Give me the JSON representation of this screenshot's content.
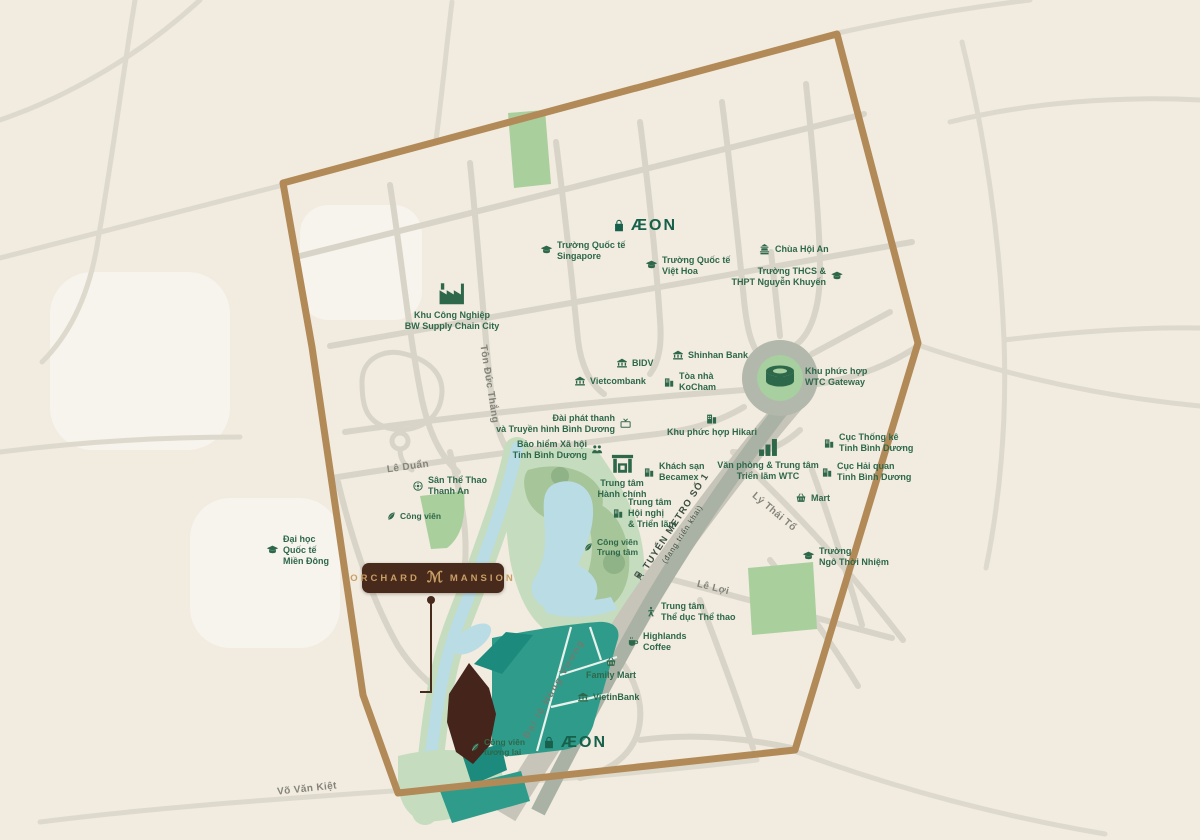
{
  "map": {
    "colors": {
      "bg": "#f1ebe0",
      "road": "#d8d4c8",
      "road_outer": "#ded9cd",
      "boundary": "#b28a58",
      "metro_band": "#a9b2a5",
      "boulevard_band": "#c7c4b9",
      "water": "#b9dce5",
      "park_light": "#c6dcbe",
      "park_mid": "#a6c598",
      "park_dark": "#8fb286",
      "green_patch": "#a9cf9d",
      "teal": "#2f9c8b",
      "teal_dark": "#1c8a7c",
      "site_brown": "#45241b",
      "poi_green": "#2e684a",
      "road_label": "#84847a",
      "metro_text": "#3a4f42",
      "aeon_green": "#17604b",
      "badge_bg": "#482a1d",
      "badge_gold": "#c89e63"
    },
    "project_badge": {
      "left": "ORCHARD",
      "monogram": "ℳ",
      "right": "MANSION"
    },
    "metro": {
      "label": "TUYẾN METRO SỐ 1",
      "sublabel": "(đang triển khai)"
    },
    "road_labels": [
      {
        "id": "le-duan",
        "text": "Lê Duẩn",
        "x": 408,
        "y": 467,
        "rot": -8,
        "variant": "plain"
      },
      {
        "id": "ton-duc-thang",
        "text": "Tôn Đức Thắng",
        "x": 489,
        "y": 384,
        "rot": 81,
        "variant": "plain"
      },
      {
        "id": "ly-thai-to",
        "text": "Lý Thái Tổ",
        "x": 774,
        "y": 512,
        "rot": 40,
        "variant": "plain"
      },
      {
        "id": "le-loi",
        "text": "Lê Lợi",
        "x": 713,
        "y": 588,
        "rot": 14,
        "variant": "plain"
      },
      {
        "id": "vo-van-kiet",
        "text": "Võ Văn Kiệt",
        "x": 307,
        "y": 789,
        "rot": -6,
        "variant": "plain"
      },
      {
        "id": "dai-lo-hung-vuong",
        "text": "Đại lộ Hùng Vương",
        "x": 554,
        "y": 689,
        "rot": -60,
        "variant": "band"
      }
    ],
    "pois": [
      {
        "id": "aeon-top",
        "icon": "bag-icon",
        "lines": [
          "ÆON"
        ],
        "x": 612,
        "y": 216,
        "layout": "row",
        "cls": "aeon",
        "icon_size": 14
      },
      {
        "id": "school-singapore",
        "icon": "school-icon",
        "lines": [
          "Trường Quốc tế",
          "Singapore"
        ],
        "x": 540,
        "y": 240,
        "layout": "row",
        "icon_size": 13
      },
      {
        "id": "school-viet-hoa",
        "icon": "school-icon",
        "lines": [
          "Trường Quốc tế",
          "Việt Hoa"
        ],
        "x": 645,
        "y": 255,
        "layout": "row",
        "icon_size": 13
      },
      {
        "id": "chua-hoi-an",
        "icon": "temple-icon",
        "lines": [
          "Chùa Hội An"
        ],
        "x": 758,
        "y": 243,
        "layout": "row",
        "icon_size": 13
      },
      {
        "id": "school-nguyen-khuyen",
        "icon": "school-icon",
        "lines": [
          "Trường THCS &",
          "THPT Nguyễn Khuyến"
        ],
        "x": 843,
        "y": 266,
        "layout": "rr",
        "icon_size": 13
      },
      {
        "id": "bw-industrial-park",
        "icon": "factory-icon",
        "lines": [
          "Khu Công Nghiệp",
          "BW Supply Chain City"
        ],
        "x": 452,
        "y": 278,
        "layout": "col",
        "icon_size": 30
      },
      {
        "id": "bidv",
        "icon": "bank-icon",
        "lines": [
          "BIDV"
        ],
        "x": 616,
        "y": 357,
        "layout": "row",
        "icon_size": 12
      },
      {
        "id": "vietcombank",
        "icon": "bank-icon",
        "lines": [
          "Vietcombank"
        ],
        "x": 574,
        "y": 375,
        "layout": "row",
        "icon_size": 12
      },
      {
        "id": "shinhan-bank",
        "icon": "bank-icon",
        "lines": [
          "Shinhan Bank"
        ],
        "x": 672,
        "y": 349,
        "layout": "row",
        "icon_size": 12
      },
      {
        "id": "kocham-tower",
        "icon": "building-icon",
        "lines": [
          "Tòa nhà",
          "KoCham"
        ],
        "x": 663,
        "y": 371,
        "layout": "row",
        "icon_size": 12
      },
      {
        "id": "binh-duong-radio-tv",
        "icon": "tv-icon",
        "lines": [
          "Đài phát thanh",
          "và Truyền hình Bình Dương"
        ],
        "x": 632,
        "y": 413,
        "layout": "rr",
        "icon_size": 13
      },
      {
        "id": "social-insurance",
        "icon": "people-icon",
        "lines": [
          "Bảo hiểm Xã hội",
          "Tỉnh Bình Dương"
        ],
        "x": 604,
        "y": 439,
        "layout": "rr",
        "icon_size": 13
      },
      {
        "id": "admin-center",
        "icon": "gate-icon",
        "lines": [
          "Trung tâm",
          "Hành chính"
        ],
        "x": 622,
        "y": 450,
        "layout": "col",
        "icon_size": 26
      },
      {
        "id": "becamex-hotel",
        "icon": "building-icon",
        "lines": [
          "Khách sạn",
          "Becamex"
        ],
        "x": 643,
        "y": 461,
        "layout": "row",
        "icon_size": 12
      },
      {
        "id": "hikari-complex",
        "icon": "building-icon",
        "lines": [
          "Khu phức hợp Hikari"
        ],
        "x": 712,
        "y": 412,
        "layout": "col",
        "icon_size": 13
      },
      {
        "id": "convention-center",
        "icon": "building-icon",
        "lines": [
          "Trung tâm",
          "Hội nghị",
          "& Triển lãm"
        ],
        "x": 612,
        "y": 497,
        "layout": "row",
        "icon_size": 12
      },
      {
        "id": "central-park",
        "icon": "leaf-icon",
        "lines": [
          "Công viên",
          "Trung tâm"
        ],
        "x": 583,
        "y": 537,
        "layout": "row",
        "cls": "sm",
        "icon_size": 10
      },
      {
        "id": "wtc-office",
        "icon": "towers-icon",
        "lines": [
          "Văn phòng & Trung tâm",
          "Triển lãm WTC"
        ],
        "x": 768,
        "y": 436,
        "layout": "col",
        "icon_size": 22
      },
      {
        "id": "statistics-dept",
        "icon": "building-icon",
        "lines": [
          "Cục Thống kê",
          "Tỉnh Bình Dương"
        ],
        "x": 823,
        "y": 432,
        "layout": "row",
        "icon_size": 12
      },
      {
        "id": "customs-dept",
        "icon": "building-icon",
        "lines": [
          "Cục Hải quan",
          "Tỉnh Bình Dương"
        ],
        "x": 821,
        "y": 461,
        "layout": "row",
        "icon_size": 12
      },
      {
        "id": "mart",
        "icon": "basket-icon",
        "lines": [
          "Mart"
        ],
        "x": 795,
        "y": 492,
        "layout": "row",
        "icon_size": 12
      },
      {
        "id": "school-ngo-thoi-nhiem",
        "icon": "school-icon",
        "lines": [
          "Trường",
          "Ngô Thời Nhiệm"
        ],
        "x": 802,
        "y": 546,
        "layout": "row",
        "icon_size": 13
      },
      {
        "id": "sports-center",
        "icon": "sports-icon",
        "lines": [
          "Trung tâm",
          "Thể dục Thể thao"
        ],
        "x": 645,
        "y": 601,
        "layout": "row",
        "icon_size": 12
      },
      {
        "id": "highlands-coffee",
        "icon": "coffee-icon",
        "lines": [
          "Highlands",
          "Coffee"
        ],
        "x": 627,
        "y": 631,
        "layout": "row",
        "icon_size": 12
      },
      {
        "id": "family-mart",
        "icon": "basket-icon",
        "lines": [
          "Family Mart"
        ],
        "x": 611,
        "y": 656,
        "layout": "col",
        "icon_size": 12
      },
      {
        "id": "vietinbank",
        "icon": "bank-icon",
        "lines": [
          "VietinBank"
        ],
        "x": 577,
        "y": 691,
        "layout": "row",
        "icon_size": 12
      },
      {
        "id": "aeon-bottom",
        "icon": "bag-icon",
        "lines": [
          "ÆON"
        ],
        "x": 542,
        "y": 733,
        "layout": "row",
        "cls": "aeon",
        "icon_size": 14
      },
      {
        "id": "eiu-university",
        "icon": "school-icon",
        "lines": [
          "Đại học",
          "Quốc tế",
          "Miền Đông"
        ],
        "x": 266,
        "y": 534,
        "layout": "row",
        "icon_size": 13
      },
      {
        "id": "thanh-an-stadium",
        "icon": "target-icon",
        "lines": [
          "Sân Thể Thao",
          "Thanh An"
        ],
        "x": 412,
        "y": 475,
        "layout": "row",
        "icon_size": 12
      },
      {
        "id": "cong-vien-left",
        "icon": "leaf-icon",
        "lines": [
          "Công viên"
        ],
        "x": 386,
        "y": 511,
        "layout": "row",
        "cls": "sm",
        "icon_size": 10
      },
      {
        "id": "future-park",
        "icon": "leaf-icon",
        "lines": [
          "Công viên",
          "tương lai"
        ],
        "x": 470,
        "y": 737,
        "layout": "row",
        "cls": "sm",
        "icon_size": 10
      },
      {
        "id": "wtc-gateway",
        "icon": null,
        "lines": [
          "Khu phức hợp",
          "WTC Gateway"
        ],
        "x": 805,
        "y": 366,
        "layout": "row"
      }
    ]
  }
}
